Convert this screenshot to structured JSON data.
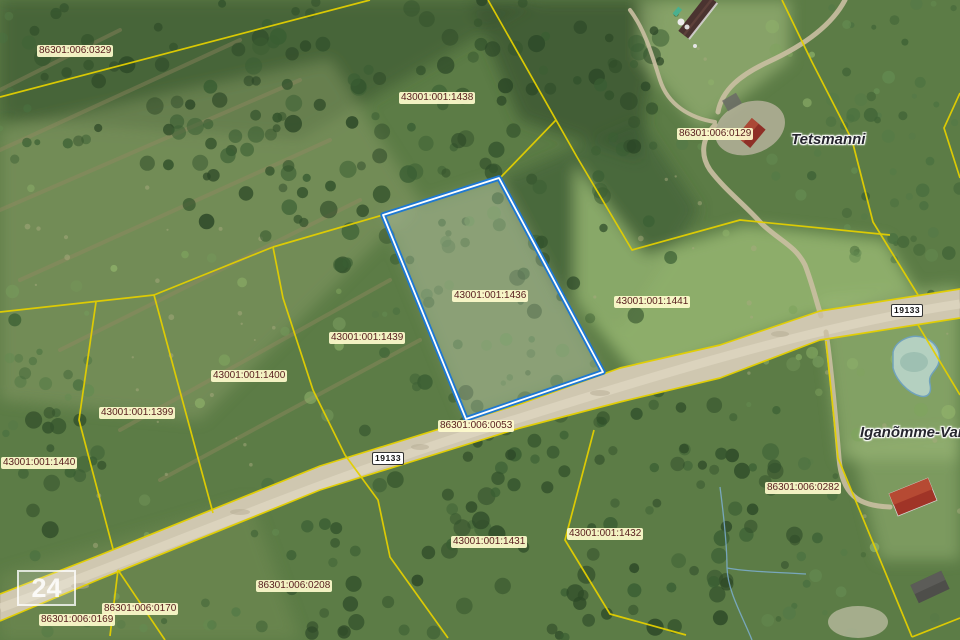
{
  "map": {
    "selected_parcel": {
      "code": "43001:001:1436"
    },
    "parcel_labels": [
      {
        "code": "86301:006:0329",
        "x": 37,
        "y": 45
      },
      {
        "code": "43001:001:1438",
        "x": 399,
        "y": 92
      },
      {
        "code": "86301:006:0129",
        "x": 677,
        "y": 128
      },
      {
        "code": "43001:001:1436",
        "x": 452,
        "y": 290
      },
      {
        "code": "43001:001:1441",
        "x": 614,
        "y": 296
      },
      {
        "code": "43001:001:1439",
        "x": 329,
        "y": 332
      },
      {
        "code": "43001:001:1400",
        "x": 211,
        "y": 370
      },
      {
        "code": "43001:001:1399",
        "x": 99,
        "y": 407
      },
      {
        "code": "43001:001:1440",
        "x": 1,
        "y": 457
      },
      {
        "code": "86301:006:0053",
        "x": 438,
        "y": 420
      },
      {
        "code": "86301:006:0282",
        "x": 765,
        "y": 482
      },
      {
        "code": "43001:001:1432",
        "x": 567,
        "y": 528
      },
      {
        "code": "43001:001:1431",
        "x": 451,
        "y": 536
      },
      {
        "code": "86301:006:0208",
        "x": 256,
        "y": 580
      },
      {
        "code": "86301:006:0170",
        "x": 102,
        "y": 603
      },
      {
        "code": "86301:006:0169",
        "x": 39,
        "y": 614
      }
    ],
    "place_labels": [
      {
        "name": "Tetsmanni",
        "x": 791,
        "y": 131
      },
      {
        "name": "Iganõmme-Vana",
        "x": 860,
        "y": 424
      }
    ],
    "road_badges": [
      {
        "number": "19133",
        "x": 372,
        "y": 452
      },
      {
        "number": "19133",
        "x": 891,
        "y": 304
      }
    ],
    "corner_marker": {
      "text": "24"
    },
    "colors": {
      "boundary": "#e3cf00",
      "selection": "#1e78d2",
      "label_text": "#5a2020",
      "label_bg": "#fffcd2",
      "place_text": "#26262e",
      "road_fill": "#cfc7b0"
    }
  }
}
